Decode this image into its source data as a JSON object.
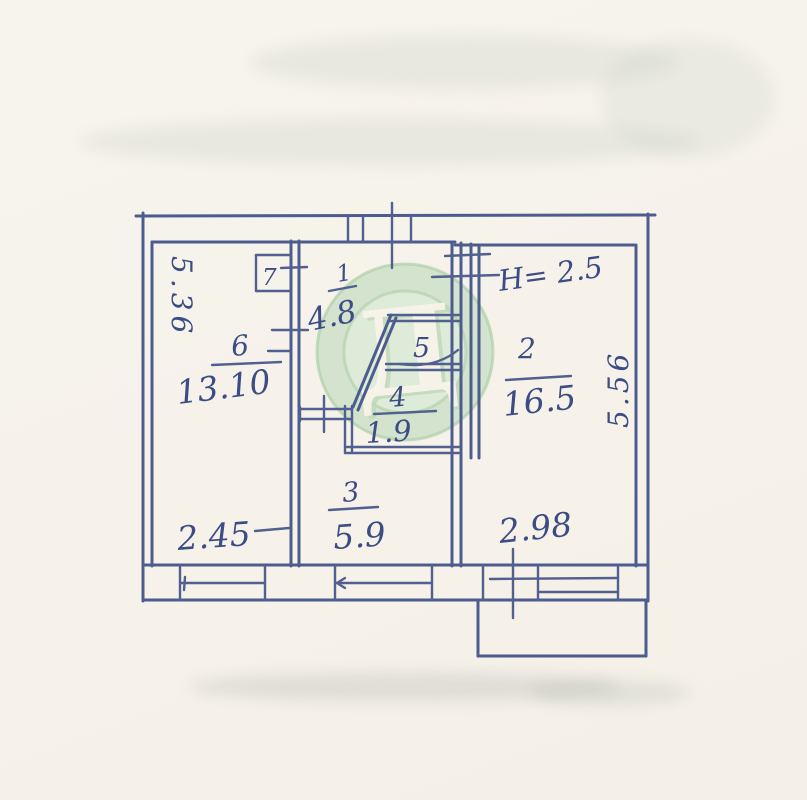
{
  "document": {
    "kind_label": "hand-drawn apartment floor plan"
  },
  "colors": {
    "paper": "#f6f2ea",
    "ink": "#4d5c8e",
    "text_ink": "#3c4c84",
    "watermark_ring": "#9fc79b",
    "watermark_fill": "#d7e8d2",
    "watermark_letter_color": "#f7f5ea"
  },
  "watermark": {
    "letter": "Д"
  },
  "floor_plan": {
    "rooms": [
      {
        "id": "hall",
        "number": "1",
        "area": "4.8"
      },
      {
        "id": "living",
        "number": "2",
        "area": "16.5"
      },
      {
        "id": "kitchen",
        "number": "3",
        "area": "5.9"
      },
      {
        "id": "bath",
        "number": "4",
        "area": "1.9"
      },
      {
        "id": "closet5",
        "number": "5",
        "area": ""
      },
      {
        "id": "bedroom",
        "number": "6",
        "area": "13.10"
      },
      {
        "id": "closet7",
        "number": "7",
        "area": ""
      }
    ],
    "dimensions": {
      "room6_width": "2.45",
      "room6_depth": "5.36",
      "room2_width": "2.98",
      "room2_depth": "5.56",
      "ceiling_height_note": "Н= 2.5"
    }
  }
}
